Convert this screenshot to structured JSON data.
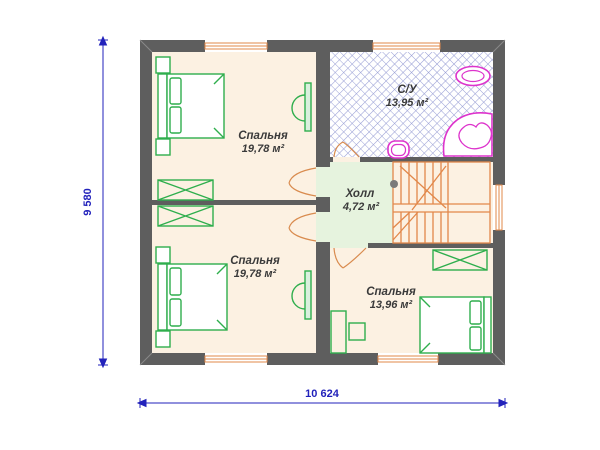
{
  "floor_plan": {
    "rooms": [
      {
        "name": "Спальня",
        "area": "19,78 м²"
      },
      {
        "name": "С/У",
        "area": "13,95 м²"
      },
      {
        "name": "Холл",
        "area": "4,72 м²"
      },
      {
        "name": "Спальня",
        "area": "19,78 м²"
      },
      {
        "name": "Спальня",
        "area": "13,96 м²"
      }
    ],
    "dimensions": {
      "width": "10 624",
      "height": "9 580"
    },
    "colors": {
      "wall": "#5e5e5e",
      "bedroom_floor": "#fcf1e2",
      "hall_floor": "#e6f3de",
      "bathroom_hatch": "#9aa0d6",
      "furniture": "#2fae4d",
      "sanitary": "#dd33cc",
      "joinery": "#e2884a",
      "dimension_blue": "#2222bb"
    }
  }
}
